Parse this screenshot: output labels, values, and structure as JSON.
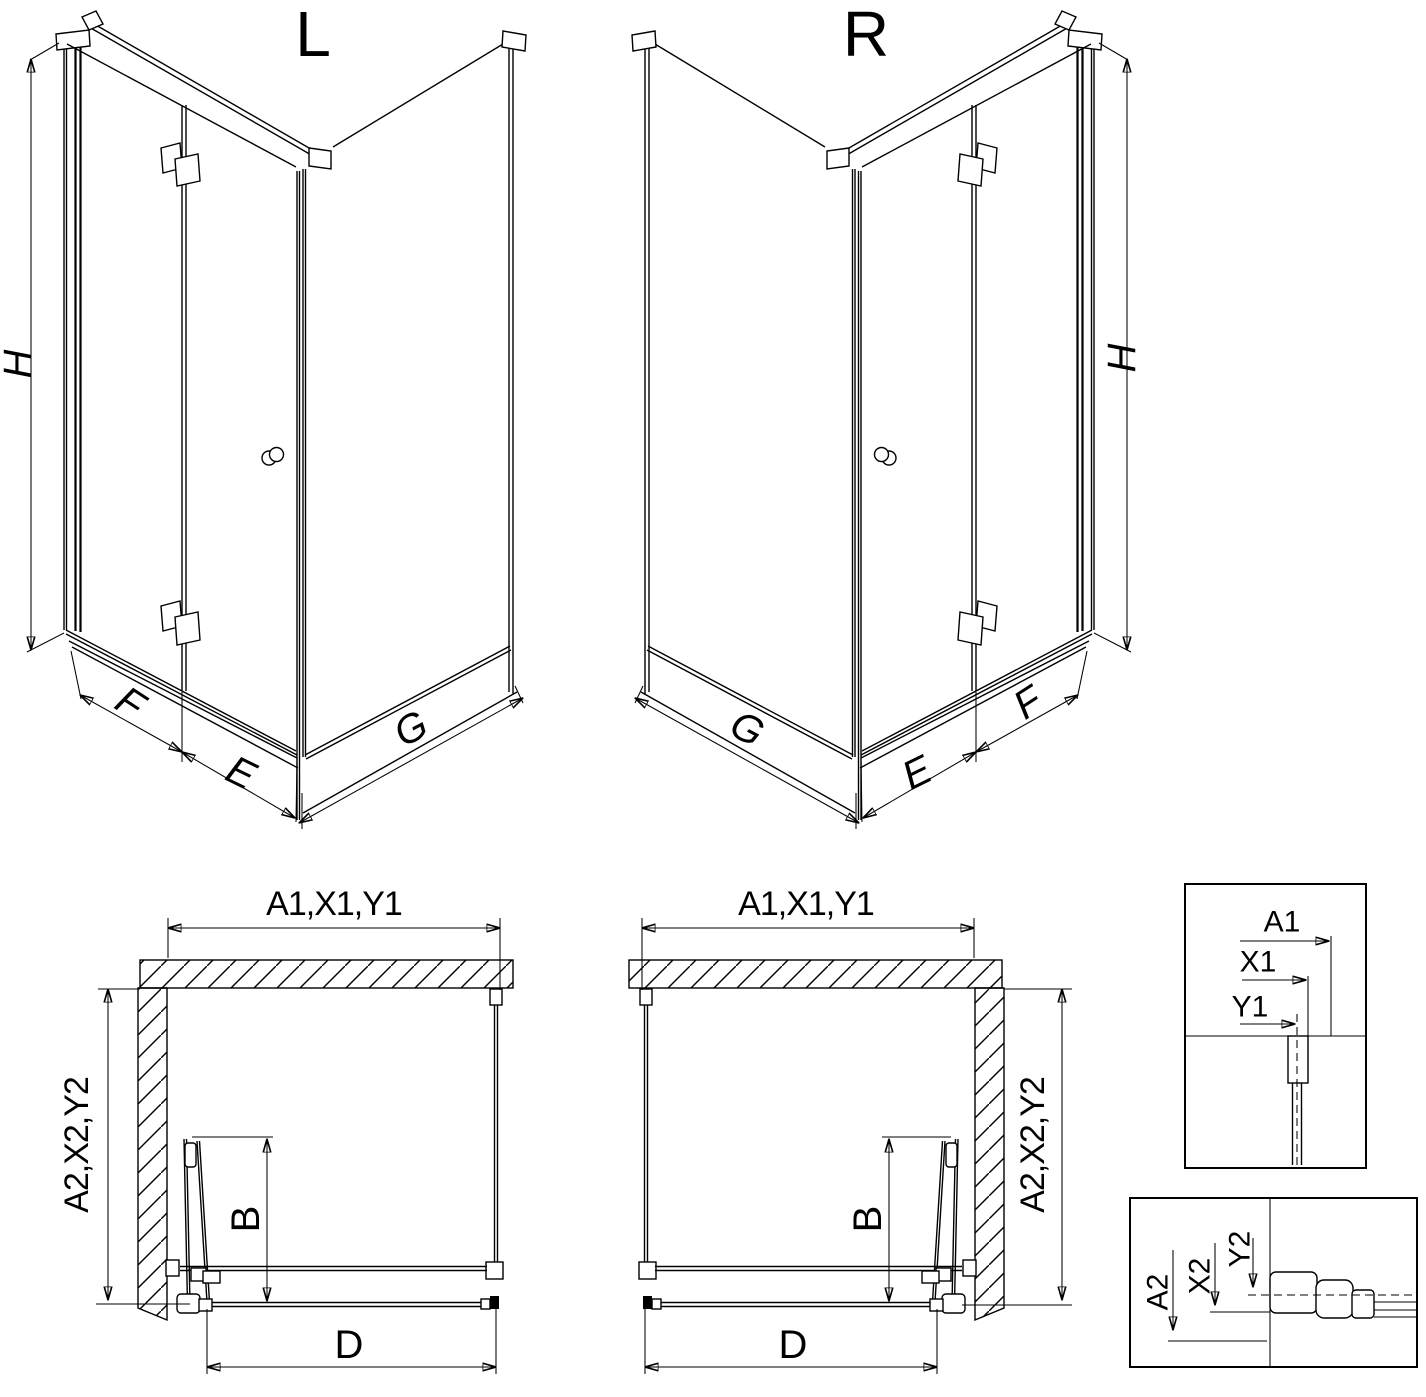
{
  "drawing": {
    "background": "#ffffff",
    "line_color": "#000000"
  },
  "perspective_views": {
    "left": {
      "title": "L",
      "height_dim": "H",
      "door_panel_dim": "F",
      "door_fixed_dim": "E",
      "side_panel_dim": "G"
    },
    "right": {
      "title": "R",
      "height_dim": "H",
      "door_panel_dim": "F",
      "door_fixed_dim": "E",
      "side_panel_dim": "G"
    }
  },
  "plan_views": {
    "left": {
      "width_dim": "A1,X1,Y1",
      "depth_dim": "A2,X2,Y2",
      "door_fold_dim": "B",
      "entry_dim": "D"
    },
    "right": {
      "width_dim": "A1,X1,Y1",
      "depth_dim": "A2,X2,Y2",
      "door_fold_dim": "B",
      "entry_dim": "D"
    }
  },
  "detail_views": {
    "top_profile": {
      "dim_a": "A1",
      "dim_x": "X1",
      "dim_y": "Y1"
    },
    "bottom_profile": {
      "dim_a": "A2",
      "dim_x": "X2",
      "dim_y": "Y2"
    }
  }
}
